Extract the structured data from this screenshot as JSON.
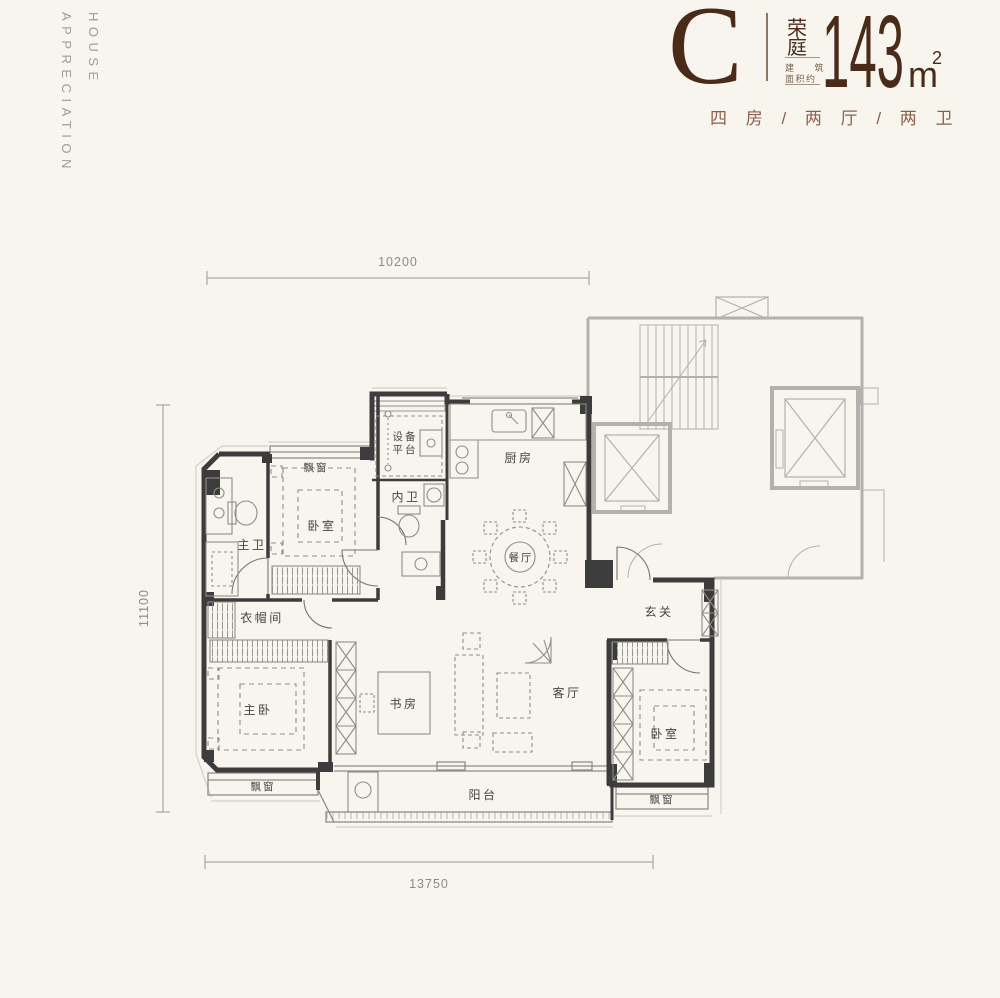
{
  "brand": {
    "line1": "HOUSE",
    "line2": "APPRECIATION"
  },
  "header": {
    "unit_letter": "C",
    "name_char1": "荣",
    "name_char2": "庭",
    "area_note_line1": "建 筑",
    "area_note_line2": "面积约",
    "area_value": "143",
    "area_unit": "m",
    "area_unit_sup": "2",
    "config": "四 房 / 两 厅 / 两 卫"
  },
  "colors": {
    "accent_brown": "#4a2a18",
    "config_brown": "#8c5f4a"
  },
  "dimensions": {
    "top": "10200",
    "left": "11100",
    "bottom": "13750"
  },
  "rooms": {
    "bay_top": "飘窗",
    "bedroom_top": "卧室",
    "master_bath": "主卫",
    "equip_line1": "设备",
    "equip_line2": "平台",
    "inner_bath": "内卫",
    "kitchen": "厨房",
    "dining": "餐厅",
    "cloakroom": "衣帽间",
    "master_bedroom": "主卧",
    "study": "书房",
    "living": "客厅",
    "foyer": "玄关",
    "bedroom_right": "卧室",
    "bay_left": "飘窗",
    "bay_right": "飘窗",
    "balcony": "阳台"
  }
}
